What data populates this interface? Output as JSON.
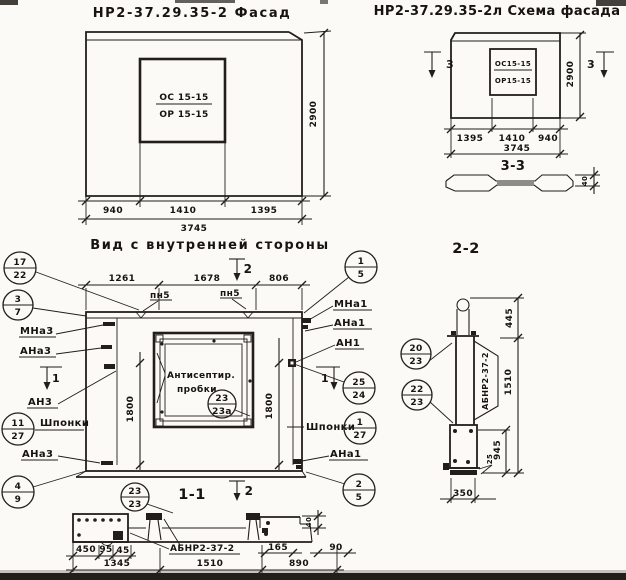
{
  "titles": {
    "facade_left": "НР2-37.29.35-2 Фасад",
    "facade_right": "НР2-37.29.35-2л Схема фасада",
    "inner_view": "Вид с внутренней стороны",
    "sec11": "1-1",
    "sec22": "2-2",
    "sec33": "3-3"
  },
  "marks": {
    "m1": "1",
    "m2": "2",
    "m3": "3"
  },
  "facade": {
    "win_top": "ОС 15-15",
    "win_bot": "ОР 15-15",
    "d940": "940",
    "d1410": "1410",
    "d1395": "1395",
    "d3745": "3745",
    "d2900": "2900"
  },
  "schema": {
    "win_top": "ОС15-15",
    "win_bot": "ОР15-15",
    "d1395": "1395",
    "d1410": "1410",
    "d940": "940",
    "d3745": "3745",
    "d2900": "2900",
    "d40": "40"
  },
  "inner": {
    "d1261": "1261",
    "d1678": "1678",
    "d806": "806",
    "d1800": "1800",
    "pn5": "пн5",
    "note1": "Антисептир.",
    "note2": "пробки",
    "shponki": "Шпонки",
    "mna3": "МНа3",
    "ana3": "АНа3",
    "an3": "АН3",
    "mna1": "МНа1",
    "ana1": "АНа1",
    "an1": "АН1"
  },
  "sec11": {
    "d450": "450",
    "d95": "95",
    "d45": "45",
    "d1345": "1345",
    "d1510": "1510",
    "d890": "890",
    "d165": "165",
    "d90": "90",
    "d40": "40",
    "brand": "АБНР2-37-2"
  },
  "sec22": {
    "d445": "445",
    "d1510": "1510",
    "d945": "945",
    "d25": "25",
    "d350": "350",
    "brand": "АБНР2-37-2"
  },
  "circles": {
    "c17_22": {
      "t": "17",
      "b": "22"
    },
    "c3_7": {
      "t": "3",
      "b": "7"
    },
    "c1_5": {
      "t": "1",
      "b": "5"
    },
    "c25_24": {
      "t": "25",
      "b": "24"
    },
    "c11_27": {
      "t": "11",
      "b": "27"
    },
    "c1_27": {
      "t": "1",
      "b": "27"
    },
    "c4_9": {
      "t": "4",
      "b": "9"
    },
    "c2_5": {
      "t": "2",
      "b": "5"
    },
    "c23_23a": {
      "t": "23",
      "b": "23а"
    },
    "c23_23": {
      "t": "23",
      "b": "23"
    },
    "c20_23": {
      "t": "20",
      "b": "23"
    },
    "c22_23": {
      "t": "22",
      "b": "23"
    }
  }
}
